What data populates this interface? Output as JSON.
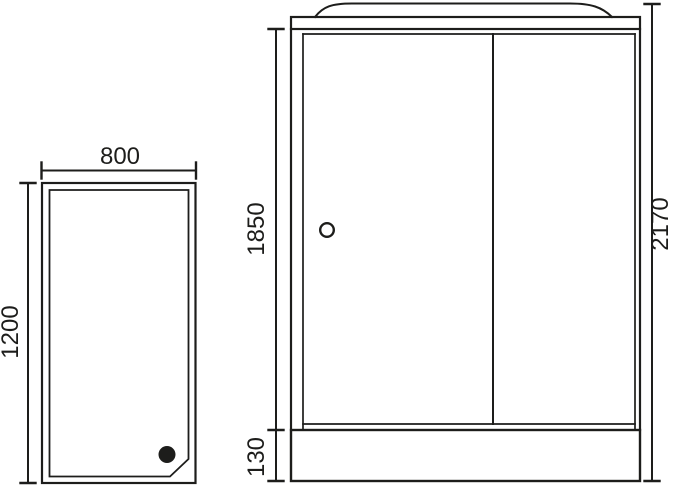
{
  "drawing": {
    "type": "technical dimension drawing of a shower cabin",
    "background_color": "#ffffff",
    "line_color": "#1d1d1b",
    "top_view": {
      "description": "shower tray plan view with corner drain",
      "width_label": "800",
      "depth_label": "1200"
    },
    "front_view": {
      "description": "shower cabin front elevation with two sliding doors, curved roof and base tray",
      "door_height_label": "1850",
      "base_height_label": "130",
      "total_height_label": "2170"
    }
  }
}
